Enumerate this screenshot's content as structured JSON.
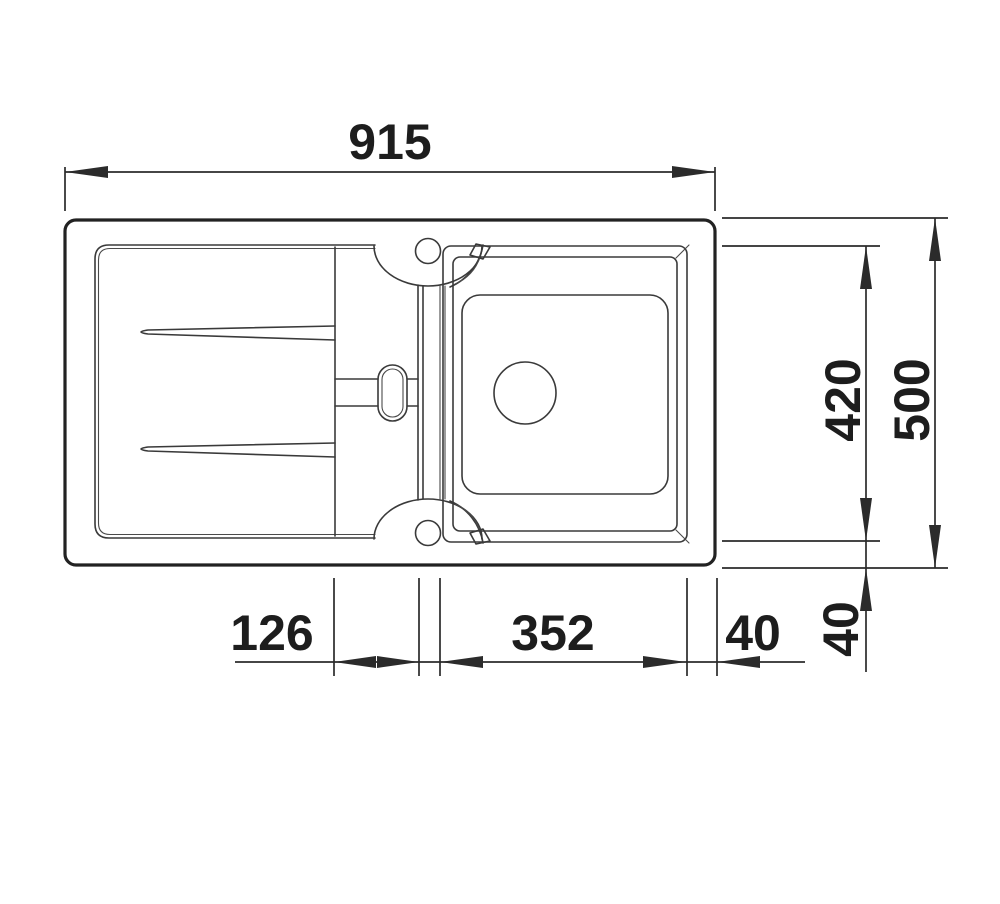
{
  "page": {
    "background": "#ffffff"
  },
  "drawing": {
    "type": "kitchen-sink-top-view-technical-drawing",
    "line_color": "#2b2b2b",
    "text_color": "#1d1d1d",
    "dims": {
      "overall_width": "915",
      "overall_depth": "500",
      "bowl_depth": "420",
      "drainer_to_bowl_gap": "126",
      "bowl_width": "352",
      "bowl_to_right_edge": "40",
      "bowl_to_bottom_edge": "40"
    }
  }
}
